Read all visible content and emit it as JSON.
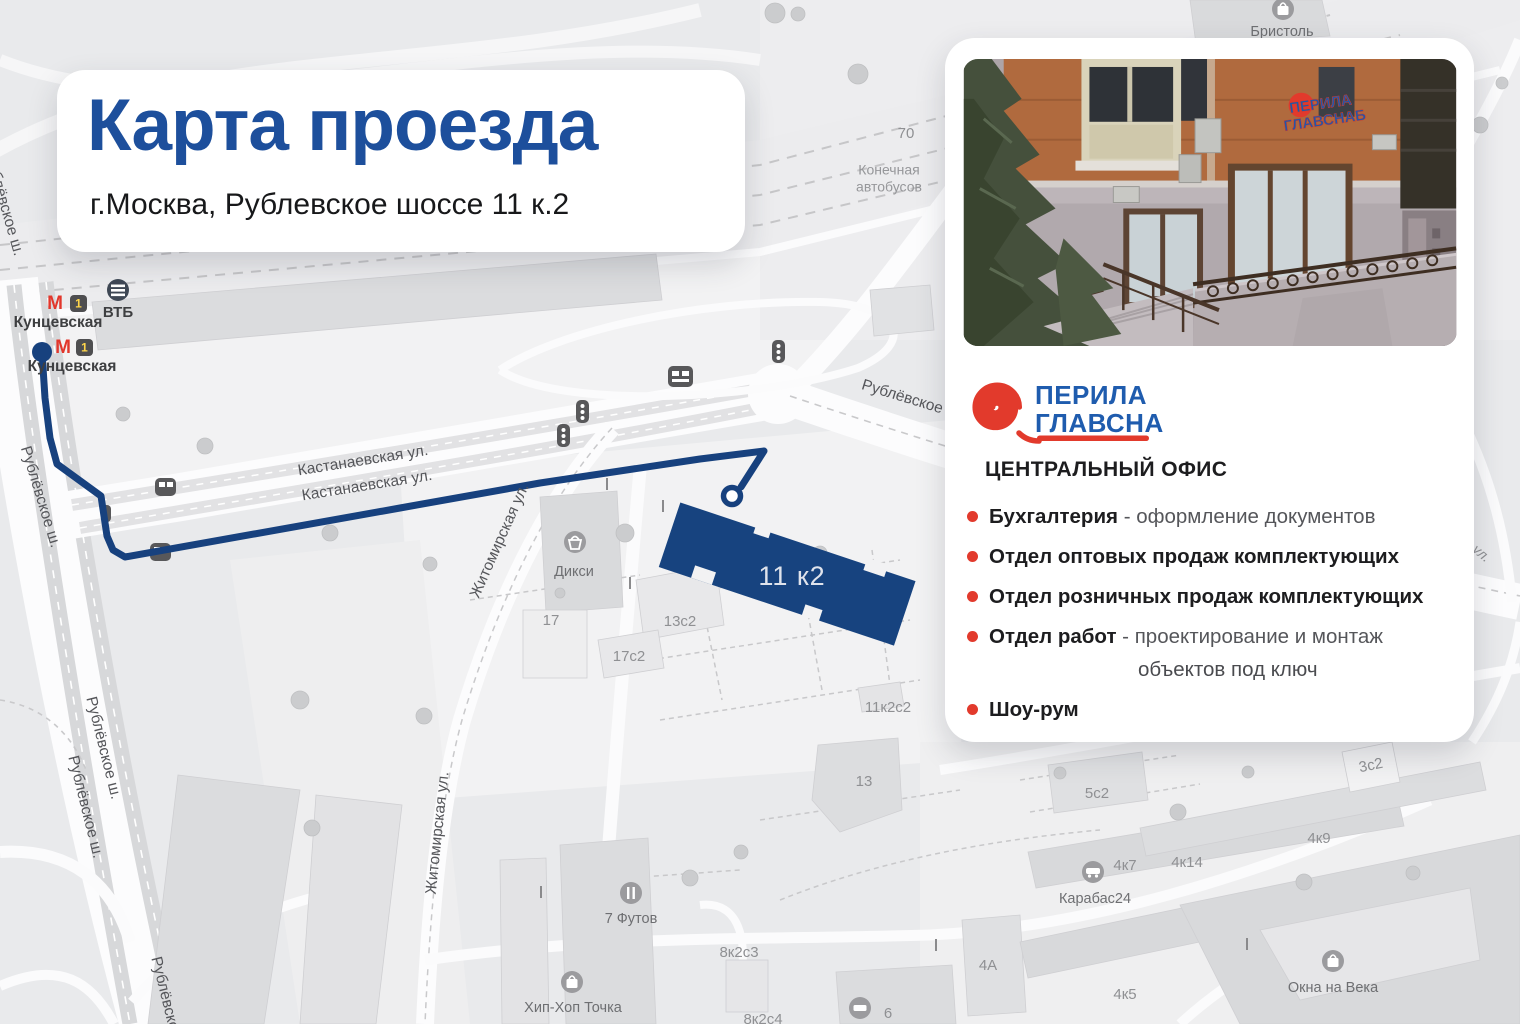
{
  "title_card": {
    "title": "Карта проезда",
    "subtitle": "г.Москва, Рублевское шоссе 11 к.2"
  },
  "info_card": {
    "logo": {
      "line1": "ПЕРИЛА",
      "line2": "ГЛАВСНАБ"
    },
    "office_heading": "ЦЕНТРАЛЬНЫЙ ОФИС",
    "items": [
      {
        "bold": "Бухгалтерия",
        "rest": " - оформление документов"
      },
      {
        "bold": "Отдел оптовых продаж комплектующих",
        "rest": ""
      },
      {
        "bold": "Отдел розничных продаж комплектующих",
        "rest": ""
      },
      {
        "bold": "Отдел работ",
        "rest": " - проектирование и монтаж"
      },
      {
        "bold": "",
        "rest": "объектов под ключ"
      },
      {
        "bold": "Шоу-рум",
        "rest": ""
      }
    ]
  },
  "map": {
    "metro": {
      "m": "М",
      "line": "1",
      "station": "Кунцевская",
      "vtb": "ВТБ"
    },
    "streets": {
      "kastanaevskaya": "Кастанаевская ул.",
      "rublevskoe_sh": "Рублёвское ш.",
      "rublevskoe_shosse": "Рублёвское шоссе",
      "zhitomirskaya": "Житомирская ул.",
      "fragment": "ул."
    },
    "pois": {
      "bristol": "Бристоль",
      "diksi": "Дикси",
      "seven_futov": "7 Футов",
      "hiphop": "Хип-Хоп Точка",
      "karabas": "Карабас24",
      "okna": "Окна на Века",
      "konechnaya_1": "Конечная",
      "konechnaya_2": "автобусов"
    },
    "buildings": {
      "b70": "70",
      "b17": "17",
      "b13s2": "13с2",
      "b17s2": "17с2",
      "b11k2s2": "11к2с2",
      "b13": "13",
      "b5s2": "5с2",
      "b3s2": "3с2",
      "b4k9": "4к9",
      "b4k7": "4к7",
      "b4k14": "4к14",
      "b4k5": "4к5",
      "b4a": "4А",
      "b6": "6",
      "b8k2s3": "8к2с3",
      "b8k2s4": "8к2с4"
    },
    "destination_label": "11 к2"
  },
  "colors": {
    "title_blue": "#1d4f9c",
    "route_navy": "#17417e",
    "brand_red": "#e23a2c",
    "brand_blue": "#1f5cae"
  }
}
